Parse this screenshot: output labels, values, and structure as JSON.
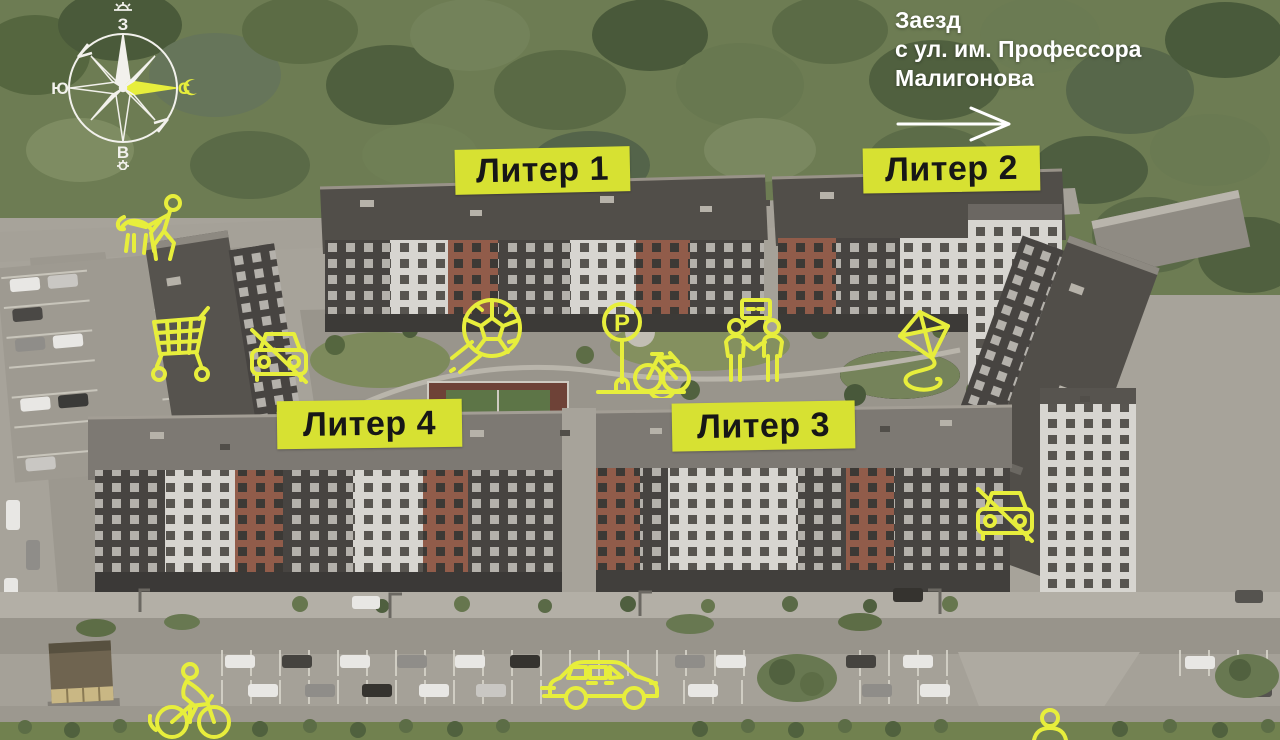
{
  "compass": {
    "west": "З",
    "south": "Ю",
    "north": "С",
    "east": "В"
  },
  "entrance": {
    "lines": [
      "Заезд",
      "с ул. им. Профессора",
      "Малигонова"
    ]
  },
  "buildings": [
    {
      "label": "Литер 1"
    },
    {
      "label": "Литер 2"
    },
    {
      "label": "Литер 3"
    },
    {
      "label": "Литер 4"
    }
  ],
  "icons_text": {
    "parking_letter": "P"
  },
  "icon_names": [
    "compass-rose-icon",
    "sunset-icon",
    "crescent-moon-icon",
    "sun-icon",
    "entrance-arrow-icon",
    "dog-walking-icon",
    "shopping-cart-icon",
    "no-cars-icon",
    "soccer-ball-icon",
    "bike-parking-icon",
    "neighbors-meeting-icon",
    "kite-icon",
    "no-cars-icon-2",
    "cyclist-icon",
    "car-driving-icon",
    "pedestrian-partial-icon"
  ],
  "colors": {
    "accent_label": "#d7e132",
    "accent_icon": "#e7ee3c",
    "label_text": "#171717",
    "note_text": "#ffffff"
  }
}
